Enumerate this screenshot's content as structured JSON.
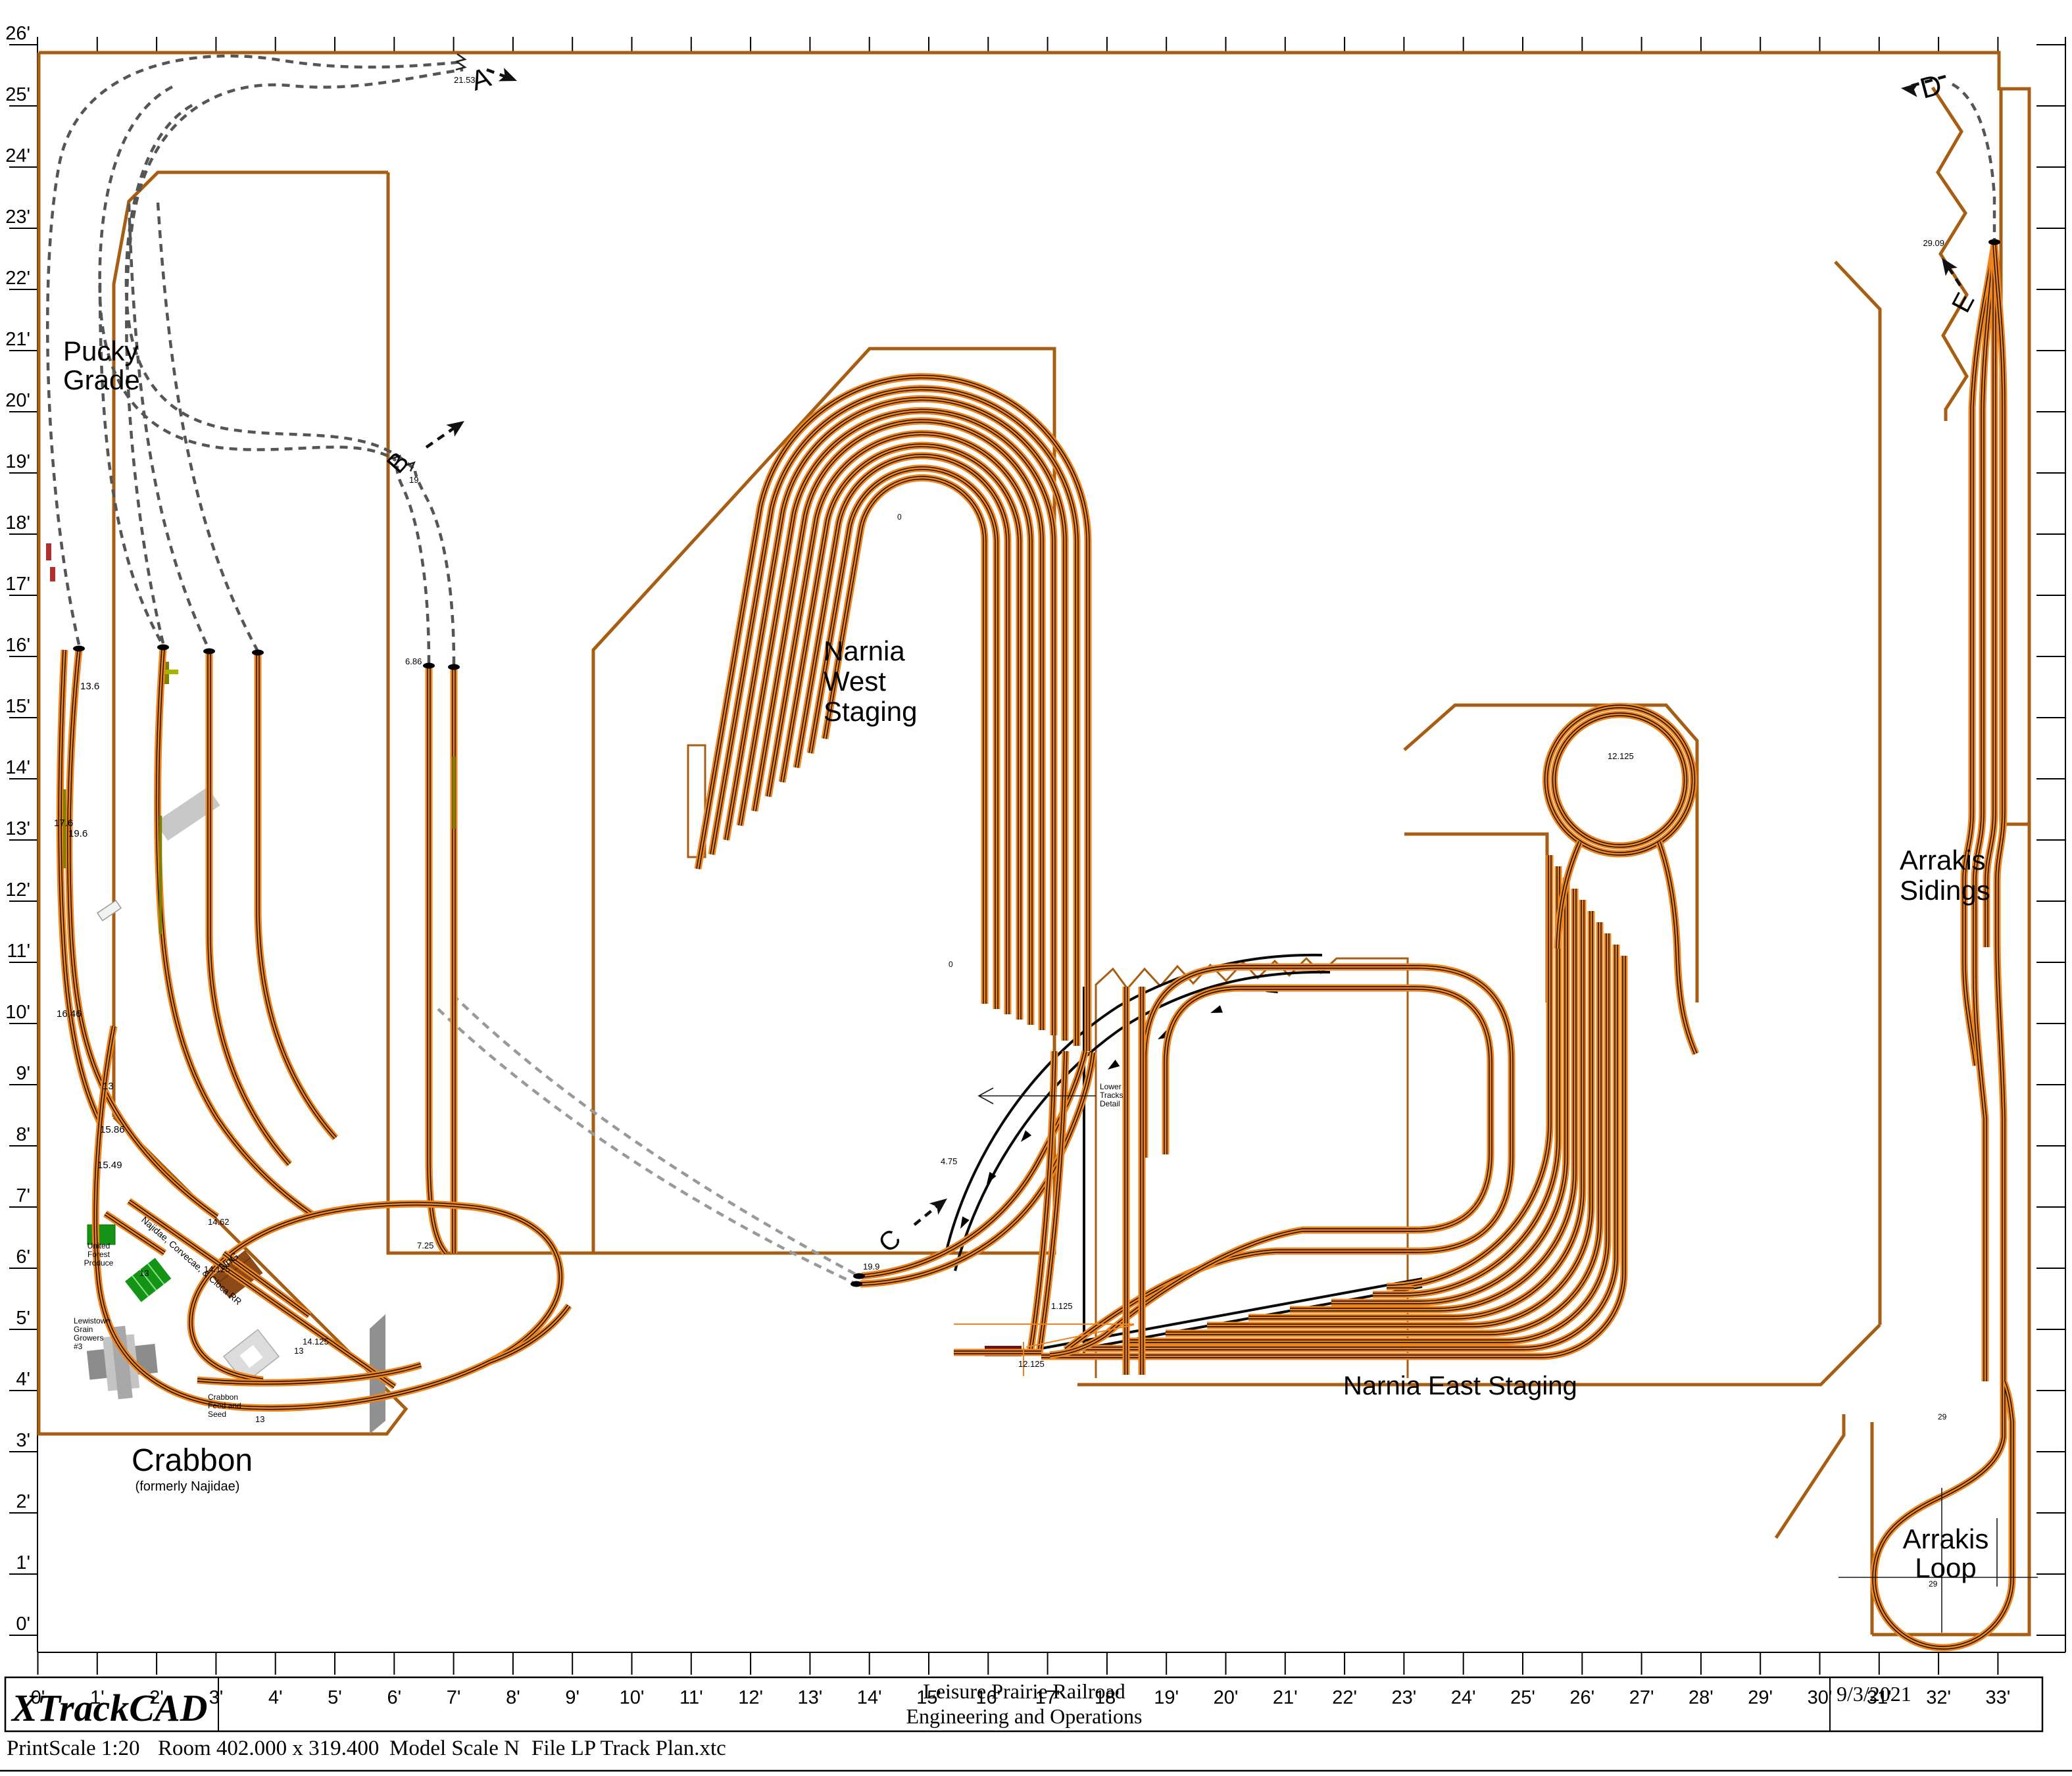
{
  "title_block": {
    "app_name": "XTrackCAD",
    "railroad_line1": "Leisure Prairie Railroad",
    "railroad_line2": "Engineering and Operations",
    "date": "9/3/2021"
  },
  "status_bar": {
    "print_scale": "PrintScale 1:20",
    "room": "Room 402.000 x 319.400",
    "model_scale": "Model Scale N",
    "file": "File LP Track Plan.xtc"
  },
  "rulers": {
    "left": [
      "0'",
      "1'",
      "2'",
      "3'",
      "4'",
      "5'",
      "6'",
      "7'",
      "8'",
      "9'",
      "10'",
      "11'",
      "12'",
      "13'",
      "14'",
      "15'",
      "16'",
      "17'",
      "18'",
      "19'",
      "20'",
      "21'",
      "22'",
      "23'",
      "24'",
      "25'",
      "26'"
    ],
    "bottom": [
      "0'",
      "1'",
      "2'",
      "3'",
      "4'",
      "5'",
      "6'",
      "7'",
      "8'",
      "9'",
      "10'",
      "11'",
      "12'",
      "13'",
      "14'",
      "15'",
      "16'",
      "17'",
      "18'",
      "19'",
      "20'",
      "21'",
      "22'",
      "23'",
      "24'",
      "25'",
      "26'",
      "27'",
      "28'",
      "29'",
      "30'",
      "31'",
      "32'",
      "33'"
    ]
  },
  "labels": {
    "pucky": [
      "Pucky",
      "Grade"
    ],
    "narnia_west": [
      "Narnia",
      "West",
      "Staging"
    ],
    "narnia_east": "Narnia East Staging",
    "arrakis_sidings": [
      "Arrakis",
      "Sidings"
    ],
    "arrakis_loop": [
      "Arrakis",
      "Loop"
    ],
    "crabbon": "Crabbon",
    "crabbon_sub": "(formerly Najidae)",
    "lower_tracks": [
      "Lower",
      "Tracks",
      "Detail"
    ],
    "najidae_rr": "Najidae, Corvecae, & Cloca RR",
    "nng": "NnG",
    "united_forest": [
      "United",
      "Forest",
      "Produce"
    ],
    "lewistown": [
      "Lewistown",
      "Grain",
      "Growers",
      "#3"
    ],
    "feed_seed": [
      "Crabbon",
      "Feed and",
      "Seed"
    ]
  },
  "connectors": {
    "a": "A",
    "b": "B",
    "c": "C",
    "d": "D",
    "e": "E"
  },
  "elevations": {
    "a": "21.53",
    "b": "19",
    "c": "19.9",
    "e": "29.09",
    "loop": "12.125",
    "yard": "12.125",
    "oval": "1.125",
    "detail": "4.75",
    "p1": "13.6",
    "p2": "17.6",
    "p3": "19.6",
    "p4": "16.46",
    "p5": "13",
    "p6": "15.86",
    "p7": "15.49",
    "c1": "14.62",
    "c2": "14.125",
    "c3": "13",
    "c4": "14.125",
    "c5": "13",
    "c6": "13",
    "m1": "6.86",
    "m2": "7.25",
    "ar1": "29",
    "ar2": "29",
    "z1": "0",
    "z2": "0"
  },
  "colors": {
    "track": "#F0841C",
    "benchwork": "#A85E12",
    "hidden_track": "#555555",
    "hidden_track_light": "#999999",
    "building_green": "#149414",
    "building_brown": "#8B4A17",
    "structure_gray": "#8C8C8C",
    "structure_light": "#DCDCDC",
    "bridge_red": "#6B1212",
    "grade_olive": "#7F7F00",
    "ramp_gray": "#909090"
  }
}
